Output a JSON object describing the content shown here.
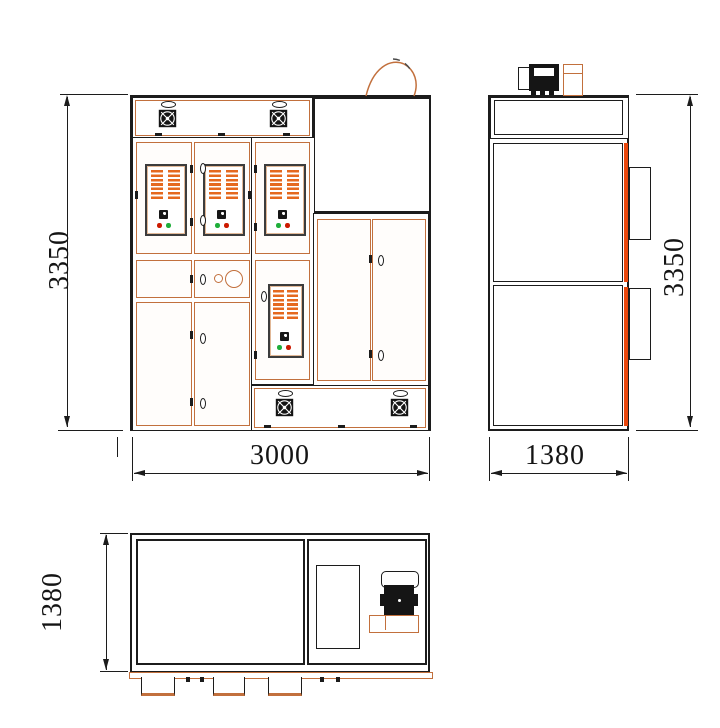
{
  "drawing": {
    "type": "cabinet three-view engineering drawing",
    "views": {
      "front": {
        "name": "front-view"
      },
      "side": {
        "name": "side-view"
      },
      "top": {
        "name": "top-view"
      }
    },
    "dims": {
      "front_height": "3350",
      "front_width": "3000",
      "side_height": "3350",
      "side_width": "1380",
      "top_depth": "1380"
    },
    "colors": {
      "line": "#1c1c1c",
      "panel_outline": "#c2703d",
      "louver": "#e5691f",
      "accent_strip": "#ea470c",
      "indicator_red": "#cc1a00",
      "indicator_green": "#1fae3a"
    },
    "icons": {
      "fan_icon": "black square with white pinwheel blades",
      "lift_handle_icon": "small black ellipse",
      "door_handle_icon": "oval 0 shape",
      "hinge_icon": "small black bar",
      "motor_icon": "black motor body with white end cap",
      "duct_icon": "orange rectangle"
    }
  }
}
